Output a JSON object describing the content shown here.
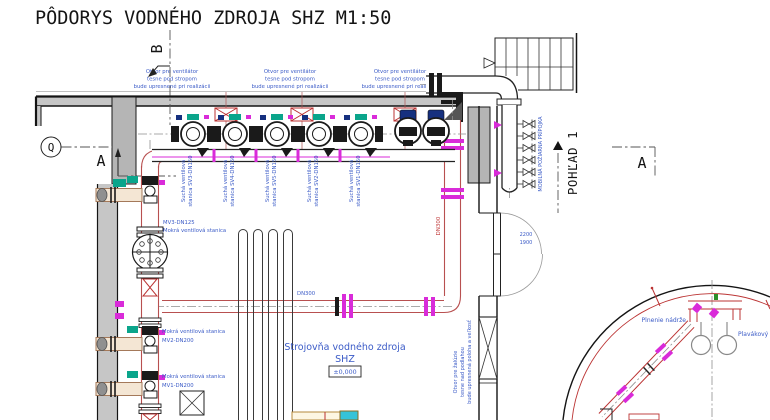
{
  "title": "PÔDORYS VODNÉHO ZDROJA SHZ M1:50",
  "markers": {
    "grid_q": "Q",
    "section_a_left": "A",
    "section_a_right": "A",
    "section_b": "B",
    "view_1": "POHĽAD 1"
  },
  "notes": {
    "vent": {
      "lines": [
        "Otvor pre ventilátor",
        "tesne pod stropom",
        "bude upresnené pri realizácii"
      ]
    },
    "louver": {
      "lines": [
        "Otvor pre žalúzie",
        "tesne nad podlahou",
        "bude upresnená poloha a veľkosť"
      ]
    }
  },
  "dry_valve_stations": [
    {
      "line1": "Suchá ventilová",
      "line2": "stanica SV3-DN150"
    },
    {
      "line1": "Suchá ventilová",
      "line2": "stanica SV4-DN150"
    },
    {
      "line1": "Suchá ventilová",
      "line2": "stanica SV5-DN150"
    },
    {
      "line1": "Suchá ventilová",
      "line2": "stanica SV2-DN150"
    },
    {
      "line1": "Suchá ventilová",
      "line2": "stanica SV1-DN150"
    }
  ],
  "wet_valve_stations": {
    "mv3": {
      "line1": "MV3-DN125",
      "line2": "Mokrá ventilová stanica"
    },
    "mv2": {
      "line1": "Mokrá ventilová stanica",
      "line2": "MV2-DN200"
    },
    "mv1": {
      "line1": "Mokrá ventilová stanica",
      "line2": "MV1-DN200"
    }
  },
  "room": {
    "name_line1": "Strojovňa vodného zdroja",
    "name_line2": "SHZ",
    "level": "±0,000"
  },
  "pipe_labels": {
    "horizontal": "DN300",
    "vertical": "DN300"
  },
  "fire_connection": "MOBILNÁ POŽIARNA PRÍPOJKA",
  "door": {
    "dim1": "2200",
    "dim2": "1900"
  },
  "tank": {
    "fill": "Plnenie nádrže",
    "float_valve": "Plavákový ventil"
  },
  "colors": {
    "label_blue": "#3b5bc7",
    "pipe_red": "#b85050",
    "magenta": "#d92bd9",
    "teal": "#0aa58b",
    "motor_blue": "#16307f",
    "wall_gray": "#c6c6c6",
    "warn_red": "#c03a3a"
  }
}
